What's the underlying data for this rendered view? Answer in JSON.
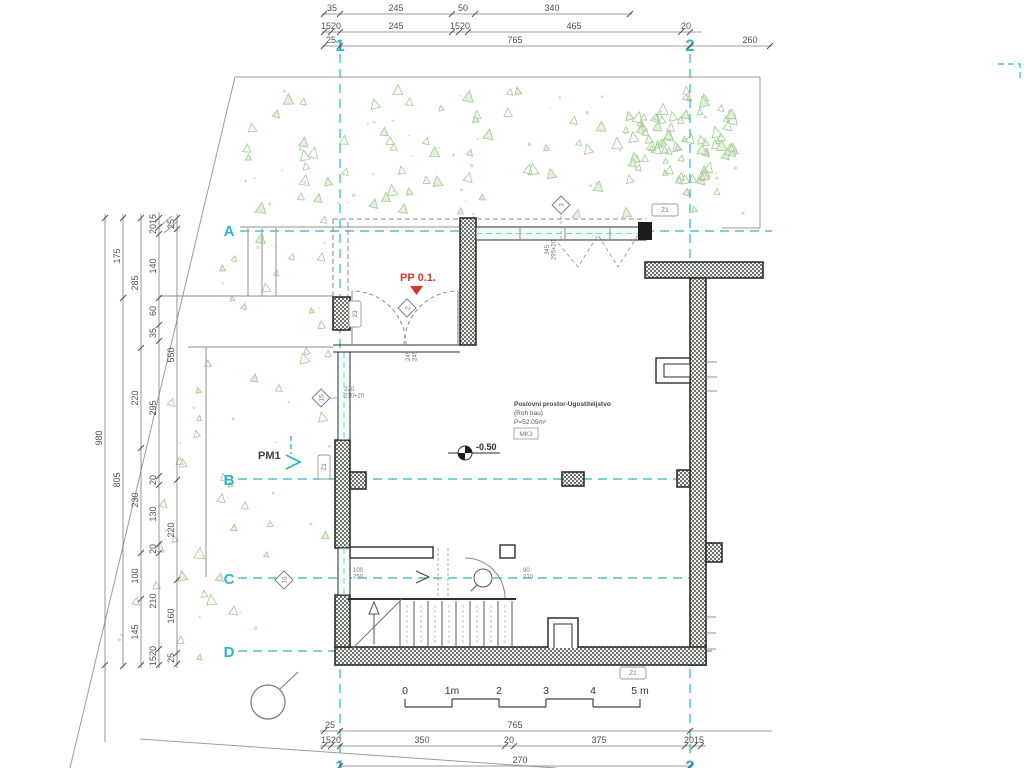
{
  "drawing": {
    "entrance_label": "PP 0.1.",
    "pm_label": "PM1",
    "level_value": "-0.50",
    "room": {
      "line1": "Poslovni prostor-Ugostiteljstvo",
      "line2": "(Roh bau)",
      "line3": "P=52.05m²",
      "tag": "MK3"
    }
  },
  "colors": {
    "accent_cyan": "#2eb5c4",
    "red": "#d6352b",
    "vegetation_stroke": "#a6cf99",
    "vegetation_fill": "#e2f1dc",
    "wall_line": "#2e2e2e",
    "dim_text": "#4f4f4f"
  },
  "grid": {
    "label_x": 229,
    "vertical": [
      {
        "label": "1",
        "x": 340,
        "top": 54,
        "bottom": 758,
        "label_top_y": 51,
        "label_bottom_y": 772
      },
      {
        "label": "2",
        "x": 690,
        "top": 54,
        "bottom": 758,
        "label_top_y": 51,
        "label_bottom_y": 772
      }
    ],
    "horizontal": [
      {
        "label": "A",
        "y": 231,
        "x1": 240,
        "x2": 772,
        "label_y": 236
      },
      {
        "label": "B",
        "y": 479,
        "x1": 238,
        "x2": 690,
        "label_y": 485
      },
      {
        "label": "C",
        "y": 578,
        "x1": 238,
        "x2": 690,
        "label_y": 584
      },
      {
        "label": "D",
        "y": 651,
        "x1": 238,
        "x2": 712,
        "label_y": 657
      }
    ]
  },
  "dims": {
    "top": [
      {
        "dir": "h",
        "y": 14,
        "x1": 322,
        "x2": 632,
        "ticks": [
          324,
          340,
          452,
          475,
          630
        ],
        "labels": [
          {
            "t": "35",
            "x": 332
          },
          {
            "t": "245",
            "x": 396
          },
          {
            "t": "50",
            "x": 463
          },
          {
            "t": "340",
            "x": 552
          }
        ]
      },
      {
        "dir": "h",
        "y": 32,
        "x1": 322,
        "x2": 702,
        "ticks": [
          324,
          331,
          340,
          452,
          459,
          468,
          681,
          690
        ],
        "labels": [
          {
            "t": "1520",
            "x": 331
          },
          {
            "t": "245",
            "x": 396
          },
          {
            "t": "1520",
            "x": 460
          },
          {
            "t": "465",
            "x": 574
          },
          {
            "t": "20",
            "x": 686
          }
        ]
      },
      {
        "dir": "h",
        "y": 46,
        "x1": 322,
        "x2": 772,
        "ticks": [
          324,
          340,
          690,
          770
        ],
        "labels": [
          {
            "t": "25",
            "x": 331
          },
          {
            "t": "765",
            "x": 515
          },
          {
            "t": "260",
            "x": 750
          }
        ]
      }
    ],
    "bottom": [
      {
        "dir": "h",
        "y": 731,
        "x1": 320,
        "x2": 772,
        "ticks": [
          324,
          340,
          690
        ],
        "labels": [
          {
            "t": "25",
            "x": 330
          },
          {
            "t": "765",
            "x": 515
          }
        ]
      },
      {
        "dir": "h",
        "y": 746,
        "x1": 320,
        "x2": 706,
        "ticks": [
          324,
          331,
          340,
          505,
          514,
          685,
          694,
          701
        ],
        "labels": [
          {
            "t": "1520",
            "x": 331
          },
          {
            "t": "350",
            "x": 422
          },
          {
            "t": "20",
            "x": 509
          },
          {
            "t": "375",
            "x": 599
          },
          {
            "t": "2015",
            "x": 694
          }
        ]
      },
      {
        "dir": "h",
        "y": 766,
        "x1": 340,
        "x2": 690,
        "ticks": [
          340,
          690
        ],
        "labels": [
          {
            "t": "270",
            "x": 520
          }
        ]
      }
    ],
    "left": [
      {
        "dir": "v",
        "x": 105,
        "y1": 214,
        "y2": 742,
        "ticks": [
          218,
          665
        ],
        "labels": [
          {
            "t": "980",
            "y": 438
          }
        ]
      },
      {
        "dir": "v",
        "x": 123,
        "y1": 214,
        "y2": 668,
        "ticks": [
          218,
          298,
          666
        ],
        "labels": [
          {
            "t": "175",
            "y": 256
          },
          {
            "t": "805",
            "y": 480
          }
        ]
      },
      {
        "dir": "v",
        "x": 141,
        "y1": 214,
        "y2": 668,
        "ticks": [
          218,
          348,
          448,
          553,
          599,
          665
        ],
        "labels": [
          {
            "t": "285",
            "y": 283
          },
          {
            "t": "220",
            "y": 398
          },
          {
            "t": "230",
            "y": 500
          },
          {
            "t": "100",
            "y": 576
          },
          {
            "t": "145",
            "y": 632
          }
        ]
      },
      {
        "dir": "v",
        "x": 159,
        "y1": 212,
        "y2": 668,
        "ticks": [
          218,
          227,
          234,
          298,
          325,
          341,
          476,
          485,
          544,
          553,
          649,
          665
        ],
        "labels": [
          {
            "t": "2015",
            "y": 224
          },
          {
            "t": "140",
            "y": 266
          },
          {
            "t": "60",
            "y": 311
          },
          {
            "t": "35",
            "y": 333
          },
          {
            "t": "295",
            "y": 408
          },
          {
            "t": "20",
            "y": 480
          },
          {
            "t": "130",
            "y": 514
          },
          {
            "t": "20",
            "y": 549
          },
          {
            "t": "210",
            "y": 601
          },
          {
            "t": "1520",
            "y": 656
          }
        ]
      },
      {
        "dir": "v",
        "x": 177,
        "y1": 214,
        "y2": 668,
        "ticks": [
          218,
          229,
          480,
          580,
          653,
          664
        ],
        "labels": [
          {
            "t": "25",
            "y": 224
          },
          {
            "t": "550",
            "y": 355
          },
          {
            "t": "220",
            "y": 530
          },
          {
            "t": "160",
            "y": 616
          },
          {
            "t": "25",
            "y": 658
          }
        ]
      }
    ]
  },
  "tags": [
    {
      "t": "Z1",
      "x": 652,
      "y": 204,
      "w": 26,
      "h": 12,
      "rot": 0
    },
    {
      "t": "Z1",
      "x": 620,
      "y": 667,
      "w": 26,
      "h": 12,
      "rot": 0
    },
    {
      "t": "Z1",
      "x": 318,
      "y": 455,
      "w": 12,
      "h": 24,
      "rot": -90
    },
    {
      "t": "23",
      "x": 349,
      "y": 301,
      "w": 12,
      "h": 26,
      "rot": -90
    }
  ],
  "diamonds": [
    {
      "t": "2",
      "cx": 407,
      "cy": 308
    },
    {
      "t": "3",
      "cx": 561,
      "cy": 205
    },
    {
      "t": "15",
      "cx": 321,
      "cy": 398
    },
    {
      "t": "16",
      "cx": 284,
      "cy": 580
    }
  ],
  "small_dims": [
    {
      "lines": [
        "220",
        "210+20"
      ],
      "x": 344,
      "y": 391,
      "rot": 0
    },
    {
      "lines": [
        "100",
        "250"
      ],
      "x": 353,
      "y": 572,
      "rot": 0
    },
    {
      "lines": [
        "90",
        "210"
      ],
      "x": 523,
      "y": 572,
      "rot": 0
    },
    {
      "lines": [
        "245",
        "245"
      ],
      "x": 410,
      "y": 356,
      "rot": -90
    },
    {
      "lines": [
        "345",
        "295+20"
      ],
      "x": 549,
      "y": 250,
      "rot": -90
    }
  ],
  "scalebar": {
    "labels": [
      "0",
      "1m",
      "2",
      "3",
      "4",
      "5 m"
    ],
    "x0": 405,
    "seg": 47,
    "label_y": 694,
    "y_top": 699,
    "y_bot": 707
  },
  "vegetation": {
    "regions": [
      {
        "kind": "band",
        "x": 245,
        "y": 88,
        "w": 505,
        "h": 132,
        "tri": 70,
        "dots": 45,
        "seed": 7
      },
      {
        "kind": "cluster",
        "cx": 682,
        "cy": 138,
        "rx": 62,
        "ry": 46,
        "tri": 72,
        "dots": 0,
        "seed": 11
      },
      {
        "kind": "leftband",
        "y1": 235,
        "y2": 662,
        "xmax": 330,
        "tri": 46,
        "dots": 22,
        "seed": 23
      }
    ]
  }
}
